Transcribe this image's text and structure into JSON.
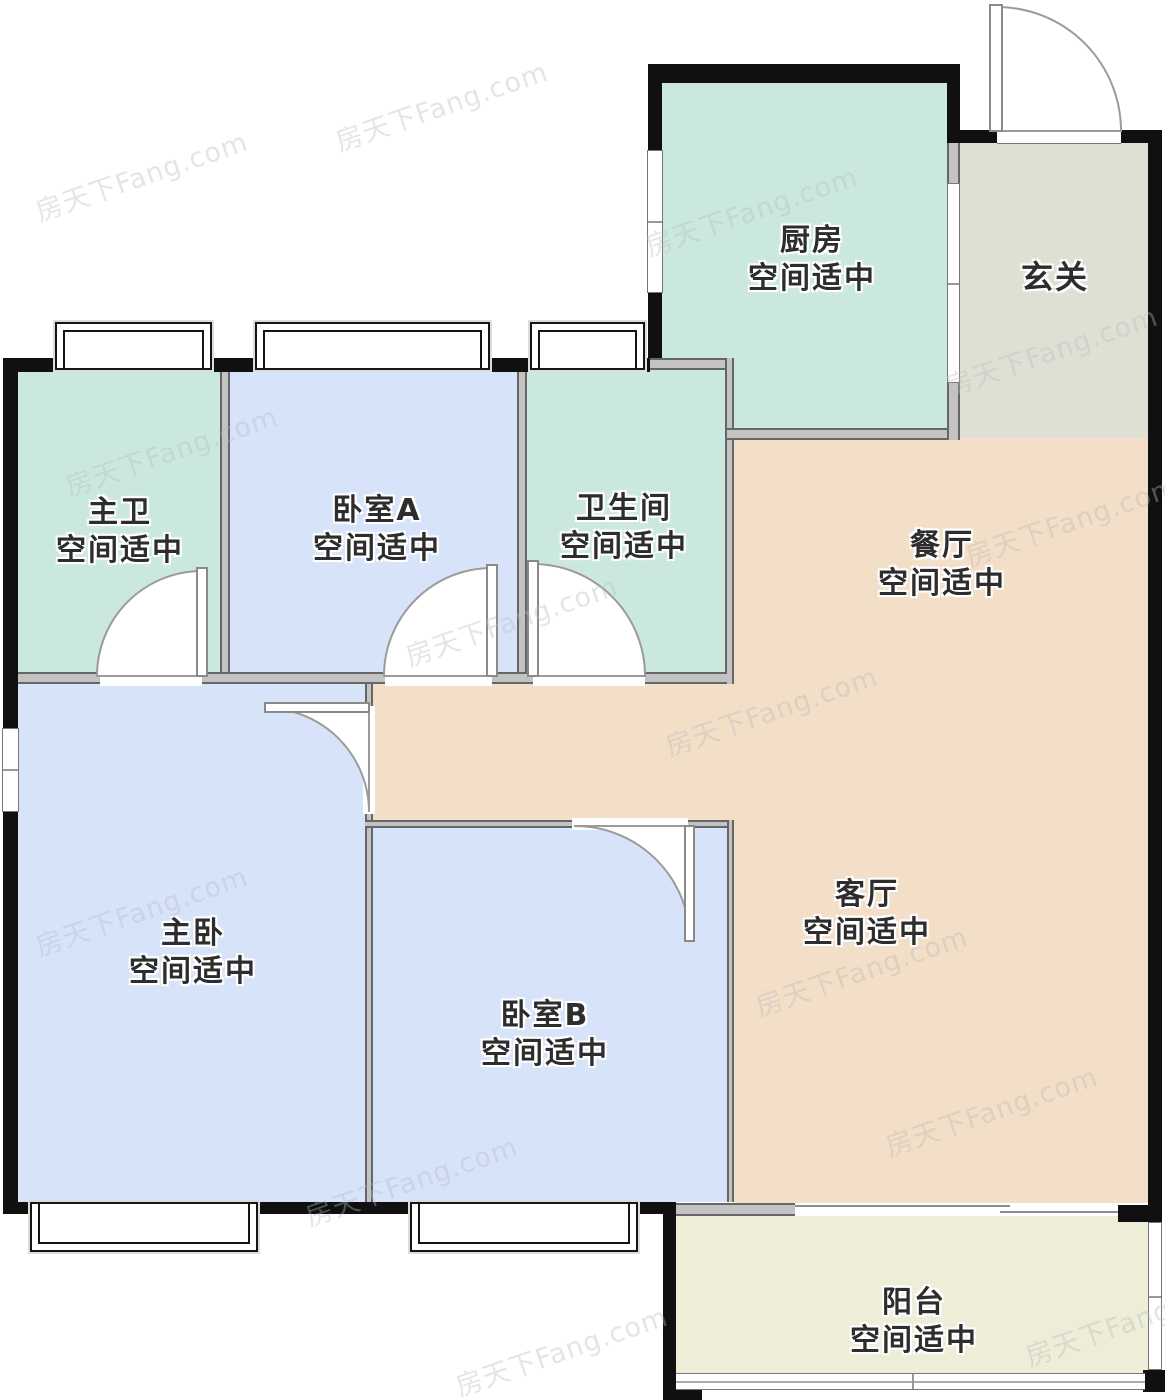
{
  "plan": {
    "watermark": "房天下Fang.com",
    "status_label": "空间适中",
    "rooms": [
      {
        "id": "kitchen",
        "name": "厨房",
        "status": "空间适中",
        "color": "#cbe8df"
      },
      {
        "id": "entry",
        "name": "玄关",
        "status": "",
        "color": "#dfe0d4"
      },
      {
        "id": "master-bath",
        "name": "主卫",
        "status": "空间适中",
        "color": "#cbe8df"
      },
      {
        "id": "bedroom-a",
        "name": "卧室A",
        "status": "空间适中",
        "color": "#d6e3f9"
      },
      {
        "id": "bath",
        "name": "卫生间",
        "status": "空间适中",
        "color": "#cbe8df"
      },
      {
        "id": "dining",
        "name": "餐厅",
        "status": "空间适中",
        "color": "#f3dec7"
      },
      {
        "id": "master-bedroom",
        "name": "主卧",
        "status": "空间适中",
        "color": "#d6e3f9"
      },
      {
        "id": "bedroom-b",
        "name": "卧室B",
        "status": "空间适中",
        "color": "#d6e3f9"
      },
      {
        "id": "living",
        "name": "客厅",
        "status": "空间适中",
        "color": "#f3dec7"
      },
      {
        "id": "balcony",
        "name": "阳台",
        "status": "空间适中",
        "color": "#eeedd8"
      }
    ],
    "palette": {
      "exterior_wall": "#101010",
      "interior_wall": "#c3c3c3",
      "door_line": "#9b9b9b",
      "label_text": "#2d2d2d"
    }
  }
}
